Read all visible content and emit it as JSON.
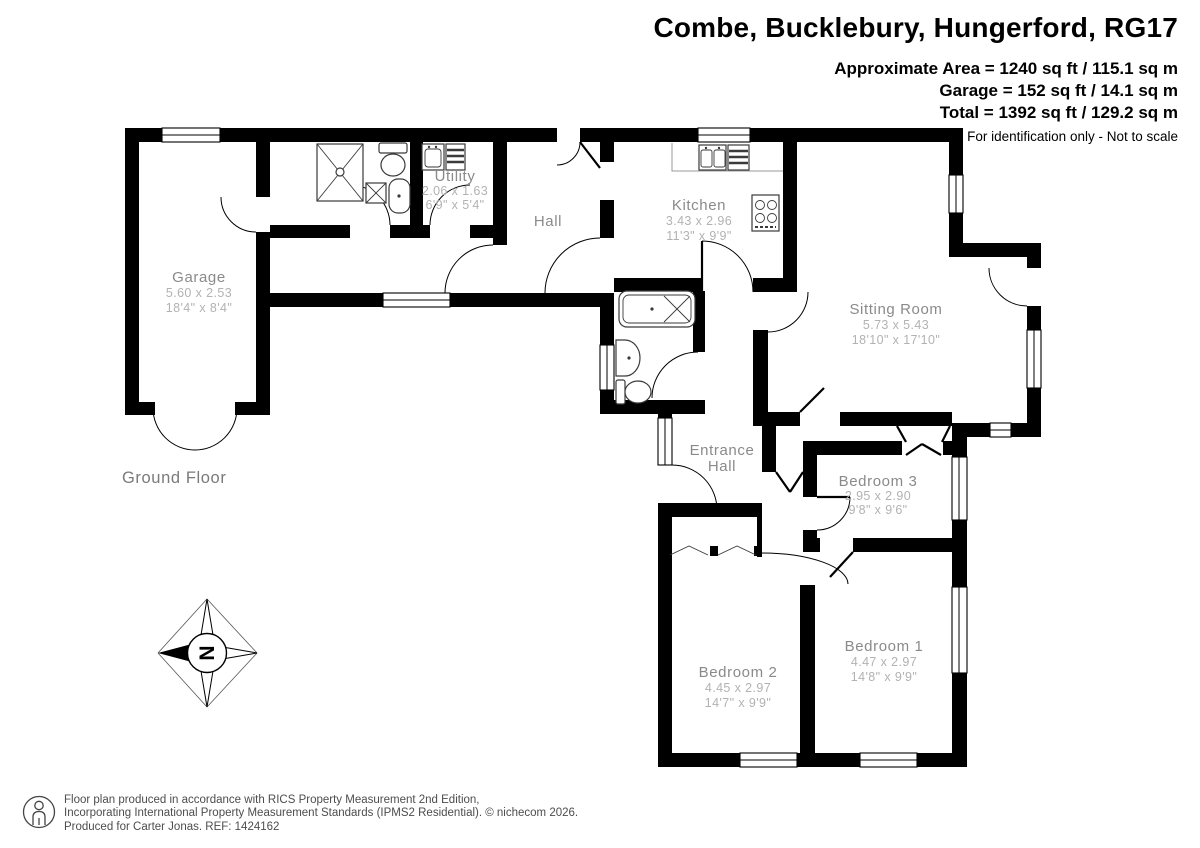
{
  "header": {
    "title": "Combe, Bucklebury, Hungerford, RG17",
    "area_line1": "Approximate Area = 1240 sq ft / 115.1 sq m",
    "area_line2": "Garage = 152 sq ft / 14.1 sq m",
    "area_line3": "Total = 1392 sq ft / 129.2 sq m",
    "disclaimer": "For identification only - Not to scale"
  },
  "floor_label": "Ground Floor",
  "compass_letter": "N",
  "rooms": {
    "garage": {
      "name": "Garage",
      "metric": "5.60 x 2.53",
      "imperial": "18'4\" x 8'4\""
    },
    "utility": {
      "name": "Utility",
      "metric": "2.06 x 1.63",
      "imperial": "6'9\" x 5'4\""
    },
    "hall": {
      "name": "Hall"
    },
    "kitchen": {
      "name": "Kitchen",
      "metric": "3.43 x 2.96",
      "imperial": "11'3\" x 9'9\""
    },
    "sitting_room": {
      "name": "Sitting Room",
      "metric": "5.73 x 5.43",
      "imperial": "18'10\" x 17'10\""
    },
    "entrance_hall": {
      "line1": "Entrance",
      "line2": "Hall"
    },
    "bedroom3": {
      "name": "Bedroom 3",
      "metric": "2.95 x 2.90",
      "imperial": "9'8\" x 9'6\""
    },
    "bedroom1": {
      "name": "Bedroom 1",
      "metric": "4.47 x 2.97",
      "imperial": "14'8\" x 9'9\""
    },
    "bedroom2": {
      "name": "Bedroom 2",
      "metric": "4.45 x 2.97",
      "imperial": "14'7\" x 9'9\""
    }
  },
  "footer": {
    "line1": "Floor plan produced in accordance with RICS Property Measurement 2nd Edition,",
    "line2": "Incorporating International Property Measurement Standards (IPMS2 Residential).   © nichecom 2026.",
    "line3": "Produced for Carter Jonas.   REF: 1424162"
  }
}
